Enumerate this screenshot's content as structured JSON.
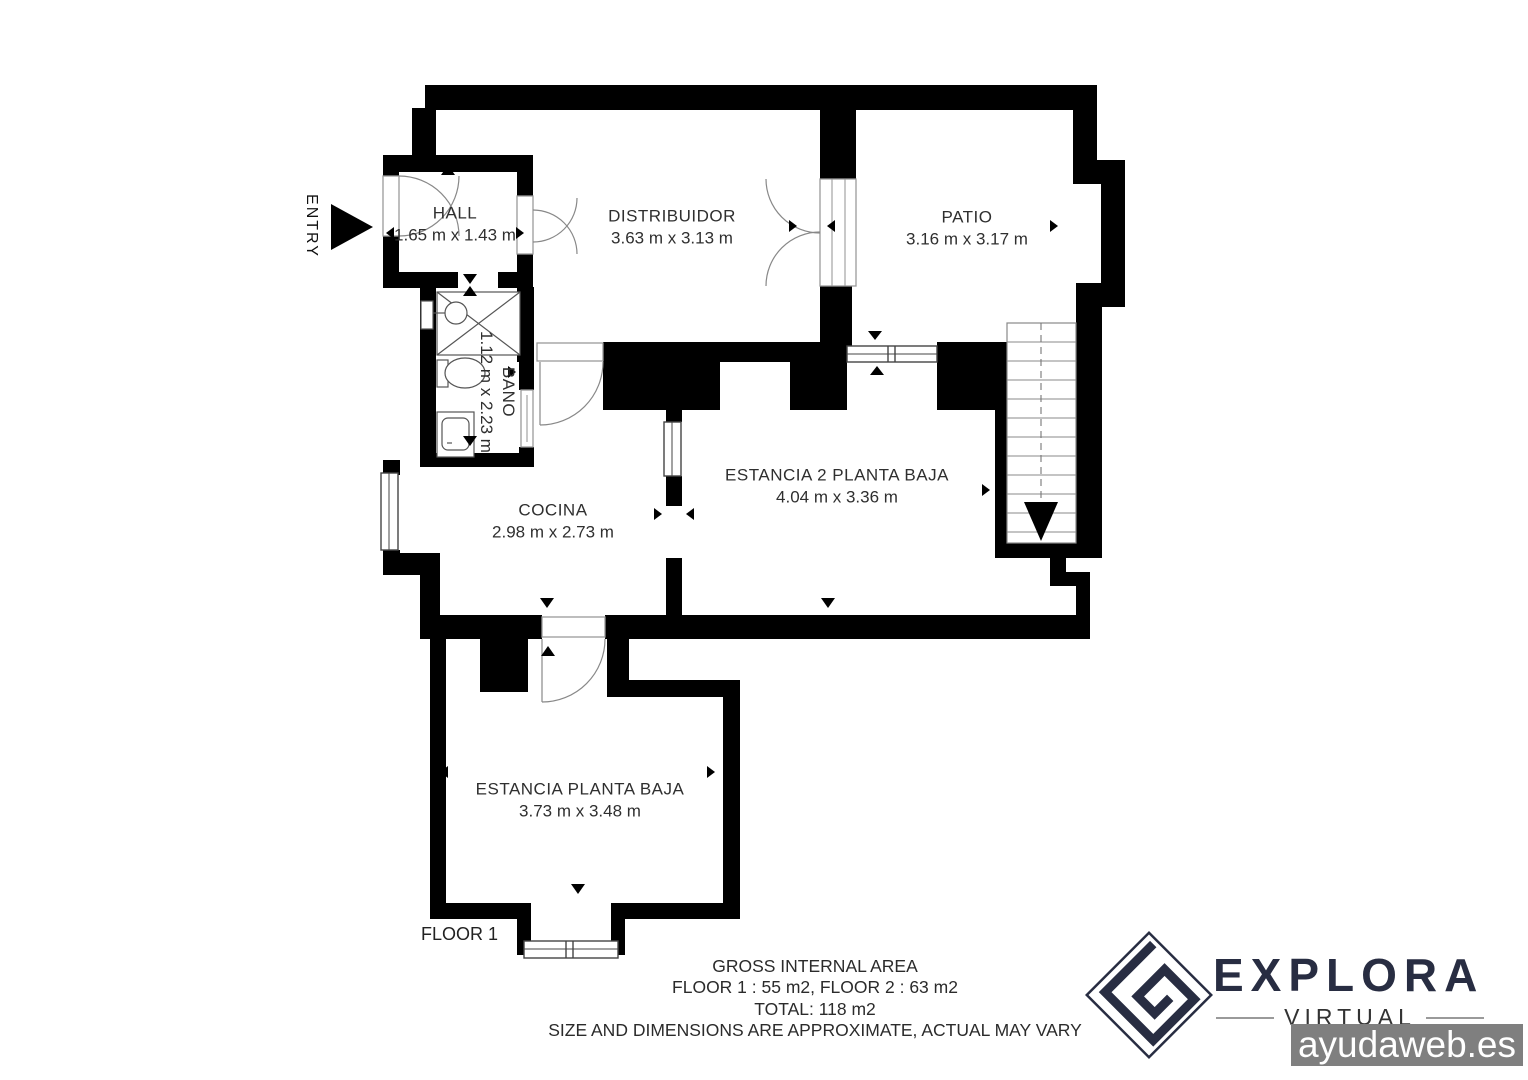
{
  "plan": {
    "entry_label": "ENTRY",
    "floor_label": "FLOOR 1",
    "rooms": {
      "hall": {
        "name": "HALL",
        "dims": "1.65 m x 1.43 m"
      },
      "distribuidor": {
        "name": "DISTRIBUIDOR",
        "dims": "3.63 m x 3.13 m"
      },
      "patio": {
        "name": "PATIO",
        "dims": "3.16 m x 3.17 m"
      },
      "bano": {
        "name": "BANO",
        "dims": "1.12 m x 2.23 m"
      },
      "cocina": {
        "name": "COCINA",
        "dims": "2.98 m x 2.73 m"
      },
      "estancia2": {
        "name": "ESTANCIA 2  PLANTA BAJA",
        "dims": "4.04 m x 3.36 m"
      },
      "estancia": {
        "name": "ESTANCIA PLANTA BAJA",
        "dims": "3.73 m x 3.48 m"
      }
    }
  },
  "footer": {
    "line1": "GROSS INTERNAL AREA",
    "line2": "FLOOR 1 : 55 m2, FLOOR 2 : 63 m2",
    "line3": "TOTAL: 118 m2",
    "line4": "SIZE AND DIMENSIONS ARE APPROXIMATE, ACTUAL MAY VARY"
  },
  "branding": {
    "name": "EXPLORA",
    "tagline": "VIRTUAL",
    "watermark": "ayudaweb.es",
    "colors": {
      "navy": "#282d42",
      "wall": "#000000",
      "watermark_bg": "#7f7f7f"
    }
  }
}
